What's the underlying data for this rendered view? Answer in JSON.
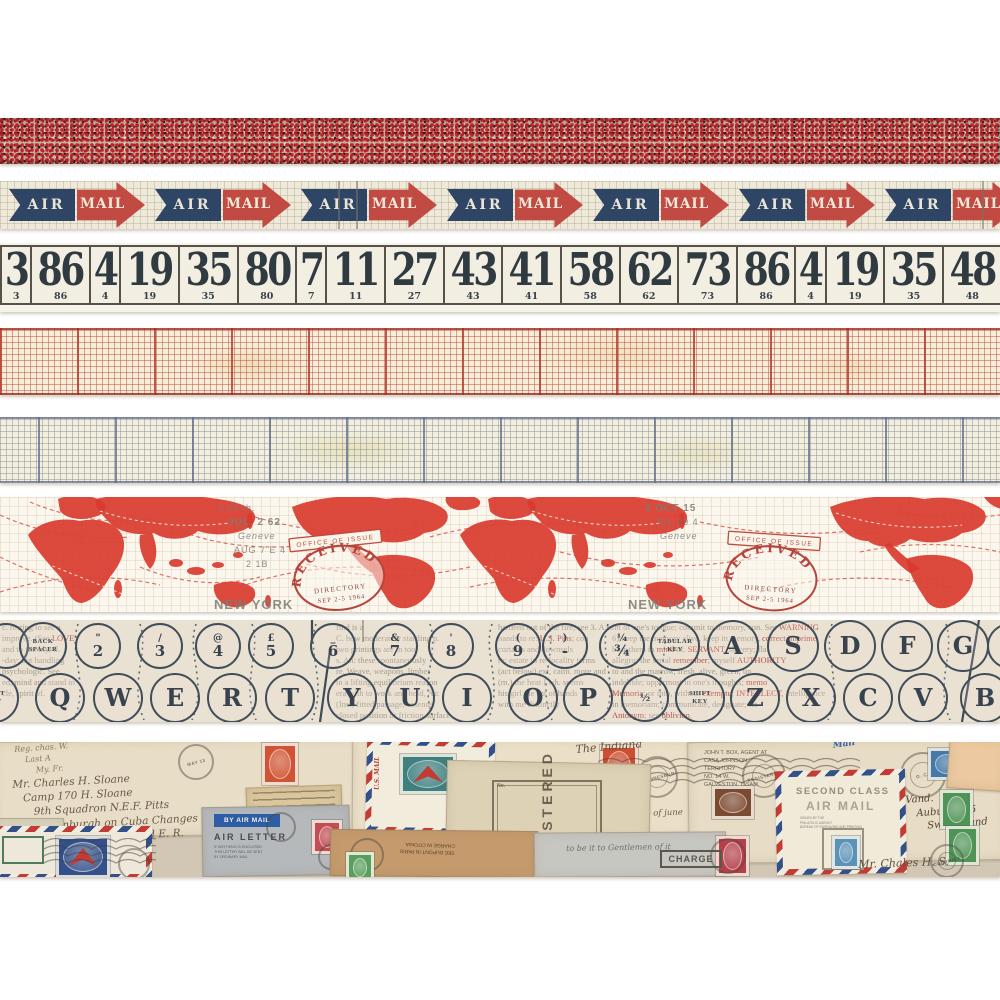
{
  "product": {
    "title": "Vintage postal design tape strips",
    "strip_names": [
      "red confetti",
      "air mail arrows",
      "ticket numbers",
      "red graph grid",
      "blue graph grid",
      "airmail world map",
      "typewriter keys",
      "vintage envelopes collage"
    ]
  },
  "palette": {
    "confetti_red": "#c0242b",
    "confetti_black": "#241f1e",
    "confetti_cream": "#e8ddc9",
    "arrow_navy": "#2e4566",
    "arrow_red": "#c14b42",
    "paper_cream": "#efe9da",
    "ticket_ink": "#2f3a41",
    "grid_red_line": "#b63e30",
    "grid_blue_line": "#6e7c96",
    "map_red": "#d9392e",
    "stamp_red": "#b5453c",
    "type_ink": "#414d5a",
    "envelope_base": "#d2c7b4"
  },
  "airmail": {
    "air_label": "AIR",
    "mail_label": "MAIL",
    "count": 7,
    "start": 3,
    "spacing": 146,
    "dark_lines": [
      338,
      356,
      982
    ]
  },
  "tickets": {
    "numbers": [
      "3",
      "86",
      "4",
      "19",
      "35",
      "80",
      "7",
      "11",
      "27",
      "43",
      "41",
      "58",
      "62",
      "73",
      "86",
      "4",
      "19",
      "35",
      "48",
      "68",
      "41",
      "58",
      "62",
      "80"
    ]
  },
  "map": {
    "stamp": {
      "banner": "OFFICE OF ISSUE",
      "arc": "RECEIVED",
      "line1": "DIRECTORY",
      "line2": "SEP 2-5 1964"
    },
    "stamp_positions": [
      {
        "x": 288,
        "y": 52,
        "rot": -6
      },
      {
        "x": 726,
        "y": 44,
        "rot": 4
      }
    ],
    "gray_texts": [
      {
        "x": 218,
        "y": 14,
        "text": "x 29 th.",
        "size": 9
      },
      {
        "x": 228,
        "y": 28,
        "text": "JUL. 2 62",
        "size": 10,
        "bold": true
      },
      {
        "x": 238,
        "y": 42,
        "text": "Geneve",
        "size": 9,
        "italic": true
      },
      {
        "x": 234,
        "y": 56,
        "text": "AUG 7 E 4",
        "size": 9
      },
      {
        "x": 246,
        "y": 70,
        "text": "2 1B",
        "size": 9
      },
      {
        "x": 645,
        "y": 14,
        "text": "3 OCT 15",
        "size": 10,
        "bold": true
      },
      {
        "x": 655,
        "y": 28,
        "text": "JUL 29 4",
        "size": 9
      },
      {
        "x": 660,
        "y": 42,
        "text": "Geneve",
        "size": 9,
        "italic": true
      },
      {
        "x": 214,
        "y": 112,
        "text": "NEW YORK",
        "size": 13,
        "bold": true
      },
      {
        "x": 628,
        "y": 112,
        "text": "NEW YORK",
        "size": 13,
        "bold": true
      }
    ]
  },
  "typewriter": {
    "top_row_y": 26,
    "bottom_row_y": 78,
    "top_row": [
      {
        "x": 6,
        "type": "sym",
        "top": "",
        "bottom": "",
        "d": 46
      },
      {
        "x": 43,
        "type": "caption",
        "lines": [
          "BACK",
          "SPACER"
        ],
        "d": 48
      },
      {
        "x": 98,
        "type": "sym",
        "top": "\"",
        "bottom": "2",
        "d": 46
      },
      {
        "x": 160,
        "type": "sym",
        "top": "/",
        "bottom": "3",
        "d": 46
      },
      {
        "x": 218,
        "type": "sym",
        "top": "@",
        "bottom": "4",
        "d": 46
      },
      {
        "x": 271,
        "type": "sym",
        "top": "£",
        "bottom": "5",
        "d": 46
      },
      {
        "x": 333,
        "type": "sym",
        "top": "_",
        "bottom": "6",
        "d": 46
      },
      {
        "x": 395,
        "type": "sym",
        "top": "&",
        "bottom": "7",
        "d": 46
      },
      {
        "x": 451,
        "type": "sym",
        "top": "'",
        "bottom": "8",
        "d": 46
      },
      {
        "x": 518,
        "type": "sym",
        "top": "(",
        "bottom": "9",
        "d": 46
      },
      {
        "x": 565,
        "type": "sym",
        "top": ")",
        "bottom": "-",
        "d": 46
      },
      {
        "x": 622,
        "type": "sym",
        "top": "¼",
        "bottom": "¾",
        "d": 46
      },
      {
        "x": 675,
        "type": "caption",
        "lines": [
          "TABULAR",
          "KEY"
        ],
        "d": 50
      },
      {
        "x": 733,
        "type": "letter",
        "label": "A",
        "d": 52
      },
      {
        "x": 793,
        "type": "letter",
        "label": "S",
        "d": 52
      },
      {
        "x": 850,
        "type": "letter",
        "label": "D",
        "d": 52
      },
      {
        "x": 907,
        "type": "letter",
        "label": "F",
        "d": 52
      },
      {
        "x": 963,
        "type": "letter",
        "label": "G",
        "d": 52
      },
      {
        "x": 1010,
        "type": "sym",
        "top": "(",
        "bottom": "",
        "d": 46
      }
    ],
    "bottom_row": [
      {
        "x": -6,
        "type": "caption",
        "lines": [
          "SHIFT",
          "KEY"
        ],
        "d": 50
      },
      {
        "x": 60,
        "type": "letter",
        "label": "Q",
        "d": 50
      },
      {
        "x": 118,
        "type": "letter",
        "label": "W",
        "d": 50
      },
      {
        "x": 175,
        "type": "letter",
        "label": "E",
        "d": 50
      },
      {
        "x": 232,
        "type": "letter",
        "label": "R",
        "d": 50
      },
      {
        "x": 290,
        "type": "letter",
        "label": "T",
        "d": 50
      },
      {
        "x": 352,
        "type": "letter",
        "label": "Y",
        "d": 50
      },
      {
        "x": 410,
        "type": "letter",
        "label": "U",
        "d": 50
      },
      {
        "x": 467,
        "type": "letter",
        "label": "I",
        "d": 50
      },
      {
        "x": 533,
        "type": "letter",
        "label": "O",
        "d": 50
      },
      {
        "x": 588,
        "type": "letter",
        "label": "P",
        "d": 50
      },
      {
        "x": 645,
        "type": "sym",
        "top": "½",
        "bottom": "",
        "d": 48
      },
      {
        "x": 700,
        "type": "caption",
        "lines": [
          "SHIFT",
          "KEY"
        ],
        "d": 50
      },
      {
        "x": 755,
        "type": "letter",
        "label": "Z",
        "d": 50
      },
      {
        "x": 811,
        "type": "letter",
        "label": "X",
        "d": 50
      },
      {
        "x": 868,
        "type": "letter",
        "label": "C",
        "d": 50
      },
      {
        "x": 923,
        "type": "letter",
        "label": "V",
        "d": 50
      },
      {
        "x": 985,
        "type": "letter",
        "label": "B",
        "d": 50
      }
    ],
    "newsprint": [
      {
        "x": 2,
        "y": 2,
        "w": 128,
        "lines": [
          "c. resting to see a",
          "improve. (See *LOVE*)",
          "and to im. hly, fl.",
          "-day; but handling",
          "psychologic. See",
          "ed, mind and stand in",
          "cle, spirit of."
        ]
      },
      {
        "x": 336,
        "y": 2,
        "w": 176,
        "lines": [
          "find is a",
          "C. how moderately startling p.",
          "two printings are in tool",
          "s. An: these spontaneously",
          "re. Weave, weapons, limber",
          "in a lifting equilibrium reason",
          "era with to work and hold, As:",
          "(Ins.) fitted passage, extends",
          "closed position or friction surface"
        ]
      },
      {
        "x": 498,
        "y": 2,
        "w": 150,
        "lines": [
          "hardens out of the fire; see 3. A re",
          "hands to re: *U.S. Pins*; con",
          "curtains and downsels",
          "re: estate in re-locality terms",
          "(act below) ext, calm. more and",
          "(m.) the heat I wh. seems",
          "his girl the cat of hands",
          "with me distinctly"
        ]
      },
      {
        "x": 612,
        "y": 2,
        "w": 386,
        "lines": [
          "tht of one's tongue; commit to memory, con. See *WARNING*",
          "6) keep the memory alive, keep in memory, *correct imprime*",
          "bear them in *mind* of. *SERVANT*, slavery; fla.",
          "allegro; the serial *remember*; myself *AUTHORITY*",
          "to and the marrow, fresh, alive, green, un",
          "indelible; uppermost in one's thoughts; *memo*",
          "*Memoria*; or into, without *exemptu*; *INTELLECT*, intelligence",
          "in memoriam; communicate, designate; let",
          "*Antonym*; see *oblivion*."
        ]
      }
    ]
  },
  "envelopes": {
    "items": [
      {
        "t": "env",
        "x": -6,
        "y": -2,
        "w": 372,
        "h": 96,
        "rot": -0.6,
        "bg": "#e8ddc6"
      },
      {
        "t": "script",
        "x": 14,
        "y": 3,
        "size": 8,
        "rot": -4,
        "color": "#8a7a64",
        "lines": [
          "Reg. chas. W.",
          "Last A",
          "My. Fr."
        ]
      },
      {
        "t": "script",
        "x": 12,
        "y": 36,
        "size": 10.5,
        "rot": -3,
        "color": "#6a5a49",
        "lines": [
          "Mr. Charles H. Sloane",
          "Camp 170 H. Sloane",
          "9th Squadron N.E.F. Pitts",
          "Edinburgh on Cuba Changes",
          "of Captain Edward E. R."
        ]
      },
      {
        "t": "postmark",
        "x": 178,
        "y": 2,
        "d": 36,
        "text": "MAY 13"
      },
      {
        "t": "stamp",
        "x": 262,
        "y": 1,
        "w": 30,
        "h": 36,
        "bg": "#cf5433"
      },
      {
        "t": "env",
        "x": 352,
        "y": -4,
        "w": 340,
        "h": 98,
        "rot": 0.4,
        "bg": "#ebdfc8"
      },
      {
        "t": "script",
        "x": 398,
        "y": 38,
        "size": 10.5,
        "rot": -2,
        "color": "#75664f",
        "lines": [
          "Mrs. Lloyd Naylor",
          "Vancouver",
          "Columbia"
        ]
      },
      {
        "t": "script",
        "x": 528,
        "y": 60,
        "size": 8.5,
        "rot": -2,
        "color": "#6f5f4c",
        "lines": [
          "Nov. Redland",
          "in safety 2 - gift of Champ of june"
        ]
      },
      {
        "t": "stamp",
        "x": 600,
        "y": 3,
        "w": 32,
        "h": 38,
        "bg": "#cd4f30"
      },
      {
        "t": "env",
        "x": 688,
        "y": -2,
        "w": 318,
        "h": 122,
        "rot": -0.8,
        "bg": "#e7dcc5"
      },
      {
        "t": "typed",
        "x": 704,
        "y": 8,
        "size": 5.5,
        "color": "#6d6254",
        "lines": [
          "JOHN T. BOX, AGENT AT",
          "CASA JOHNSON",
          "TERRITORY",
          "NO. 14 W.",
          "GALVESTON, T. SAM."
        ]
      },
      {
        "t": "postmark",
        "x": 900,
        "y": 10,
        "d": 46,
        "text": "O. C.",
        "inner": true
      },
      {
        "t": "hatch",
        "x": 950,
        "y": 12,
        "w": 52,
        "h": 34
      },
      {
        "t": "script",
        "x": 575,
        "y": 1,
        "size": 11,
        "rot": -5,
        "color": "#5f5140",
        "lines": [
          "The Indiana"
        ]
      },
      {
        "t": "wavy",
        "x": 598,
        "y": 16,
        "w": 262,
        "h": 36
      },
      {
        "t": "postmark",
        "x": 636,
        "y": 14,
        "d": 42,
        "text": "JOHANNESBURG",
        "inner": true
      },
      {
        "t": "postmark",
        "x": 742,
        "y": 12,
        "d": 44,
        "text": "REGISTERED",
        "inner": true
      },
      {
        "t": "stamp",
        "x": 928,
        "y": 6,
        "w": 32,
        "h": 26,
        "bg": "#4679a8"
      },
      {
        "t": "script",
        "x": 905,
        "y": 52,
        "size": 10,
        "rot": -4,
        "color": "#4f4538",
        "lines": [
          "Vand.",
          "Auburn 115",
          "Switzerland"
        ]
      },
      {
        "t": "scrap",
        "x": 246,
        "y": 44,
        "w": 96,
        "h": 27,
        "rot": -2,
        "bg": "#dcc69c"
      },
      {
        "t": "airmail_env",
        "x": 366,
        "y": -2,
        "w": 128,
        "h": 94,
        "rot": 1.5,
        "bg": "#f2ecdd"
      },
      {
        "t": "stamp",
        "x": 400,
        "y": 12,
        "w": 50,
        "h": 34,
        "bg": "#3f7f7e",
        "eagle": true
      },
      {
        "t": "script",
        "x": 374,
        "y": 48,
        "size": 6,
        "rot": -90,
        "color": "#b5443c",
        "lines": [
          "U.S. MAIL"
        ],
        "bold": true
      },
      {
        "t": "env",
        "x": 446,
        "y": 20,
        "w": 204,
        "h": 112,
        "rot": 1.2,
        "bg": "#ded2b6"
      },
      {
        "t": "regbox",
        "x": 492,
        "y": 38,
        "w": 110,
        "h": 70,
        "text": "REGISTERED",
        "sub": "No."
      },
      {
        "t": "env",
        "x": 202,
        "y": 64,
        "w": 148,
        "h": 70,
        "rot": -1,
        "bg": "#b6b9bb"
      },
      {
        "t": "label",
        "x": 214,
        "y": 72,
        "w": 66,
        "h": 13,
        "bg": "#2d5ea5",
        "text": "BY AIR MAIL"
      },
      {
        "t": "stamped",
        "x": 214,
        "y": 90,
        "text": "AIR LETTER",
        "size": 9,
        "ls": 2,
        "color": "#3a4046"
      },
      {
        "t": "typed",
        "x": 214,
        "y": 103,
        "size": 3.6,
        "color": "#5d6166",
        "lines": [
          "IF ANYTHING IS ENCLOSED",
          "THIS LETTER WILL BE SENT",
          "BY ORDINARY MAIL"
        ]
      },
      {
        "t": "postmark",
        "x": 266,
        "y": 70,
        "d": 30,
        "text": ""
      },
      {
        "t": "stamp",
        "x": 312,
        "y": 78,
        "w": 24,
        "h": 28,
        "bg": "#c24d55"
      },
      {
        "t": "postmark",
        "x": 318,
        "y": 102,
        "d": 26,
        "text": ""
      },
      {
        "t": "env",
        "x": -8,
        "y": 76,
        "w": 72,
        "h": 36,
        "rot": 0,
        "bg": "#d9d4be"
      },
      {
        "t": "airmail_env",
        "x": -6,
        "y": 84,
        "w": 158,
        "h": 54,
        "rot": 0,
        "bg": "#eee8da"
      },
      {
        "t": "stamp",
        "x": 56,
        "y": 94,
        "w": 48,
        "h": 36,
        "bg": "#33508a",
        "eagle": true
      },
      {
        "t": "wavy",
        "x": 44,
        "y": 96,
        "w": 112,
        "h": 30
      },
      {
        "t": "postmark",
        "x": 118,
        "y": 106,
        "d": 32,
        "text": ""
      },
      {
        "t": "box_text",
        "x": 2,
        "y": 94,
        "w": 42,
        "h": 28,
        "text": "",
        "border": "#4e7a62"
      },
      {
        "t": "env",
        "x": 330,
        "y": 88,
        "w": 208,
        "h": 47,
        "rot": 0.6,
        "bg": "#c59b6d"
      },
      {
        "t": "typed",
        "x": 400,
        "y": 98,
        "size": 5,
        "rot": 182,
        "color": "#5a4328",
        "lines": [
          "SEE DUPONT IN PARIS",
          "CHARGE IN CITONIA"
        ]
      },
      {
        "t": "postmark",
        "x": 350,
        "y": 96,
        "d": 34,
        "text": ""
      },
      {
        "t": "stamp",
        "x": 346,
        "y": 110,
        "w": 22,
        "h": 25,
        "bg": "#5a9e5d"
      },
      {
        "t": "env",
        "x": 534,
        "y": 90,
        "w": 192,
        "h": 45,
        "rot": -0.4,
        "bg": "#c7c7c2"
      },
      {
        "t": "script",
        "x": 566,
        "y": 102,
        "size": 8,
        "rot": -1,
        "color": "#70706a",
        "lines": [
          "to be it to Gentlemen of it"
        ]
      },
      {
        "t": "stamp",
        "x": 716,
        "y": 94,
        "w": 27,
        "h": 34,
        "bg": "#b5404a"
      },
      {
        "t": "postmark",
        "x": 710,
        "y": 96,
        "d": 36,
        "text": ""
      },
      {
        "t": "box_text",
        "x": 660,
        "y": 108,
        "w": 62,
        "h": 18,
        "text": "CHARGE",
        "border": "#5d564c",
        "color": "#5d564c"
      },
      {
        "t": "airmail_env",
        "x": 776,
        "y": 28,
        "w": 130,
        "h": 104,
        "rot": -1.2,
        "bg": "#f0ead9"
      },
      {
        "t": "stamped",
        "x": 796,
        "y": 44,
        "text": "SECOND CLASS",
        "size": 9.5,
        "ls": 1.5,
        "color": "#8d8476"
      },
      {
        "t": "stamped",
        "x": 806,
        "y": 57,
        "text": "AIR MAIL",
        "size": 12,
        "ls": 2,
        "color": "#a59a8c"
      },
      {
        "t": "typed",
        "x": 800,
        "y": 74,
        "size": 3.2,
        "color": "#8a8174",
        "lines": [
          "ISSUED BY THE",
          "PHILATELIC AGENCY",
          "BUREAU OF ENGRAVING AND PRINTING"
        ]
      },
      {
        "t": "box_text",
        "x": 822,
        "y": 86,
        "w": 42,
        "h": 42,
        "text": "",
        "border": "#9a9184"
      },
      {
        "t": "stamp",
        "x": 832,
        "y": 94,
        "w": 22,
        "h": 27,
        "bg": "#5b93b8"
      },
      {
        "t": "env",
        "x": 948,
        "y": -4,
        "w": 58,
        "h": 52,
        "rot": 4,
        "bg": "#ecc9a0"
      },
      {
        "t": "stamp",
        "x": 940,
        "y": 48,
        "w": 27,
        "h": 33,
        "bg": "#4f9456"
      },
      {
        "t": "stamp",
        "x": 946,
        "y": 84,
        "w": 27,
        "h": 33,
        "bg": "#4f9456"
      },
      {
        "t": "stamp",
        "x": 712,
        "y": 44,
        "w": 36,
        "h": 27,
        "bg": "#7c4a30"
      },
      {
        "t": "script",
        "x": 832,
        "y": -2,
        "size": 9,
        "rot": -8,
        "color": "#3b5fa0",
        "lines": [
          "Mail"
        ],
        "bold": true
      },
      {
        "t": "script",
        "x": 858,
        "y": 116,
        "size": 11,
        "rot": -2,
        "color": "#5f5140",
        "lines": [
          "Mr. Chales H. S."
        ]
      },
      {
        "t": "postmark",
        "x": 930,
        "y": 102,
        "d": 34,
        "text": "COLUMBIA",
        "inner": true
      }
    ]
  }
}
